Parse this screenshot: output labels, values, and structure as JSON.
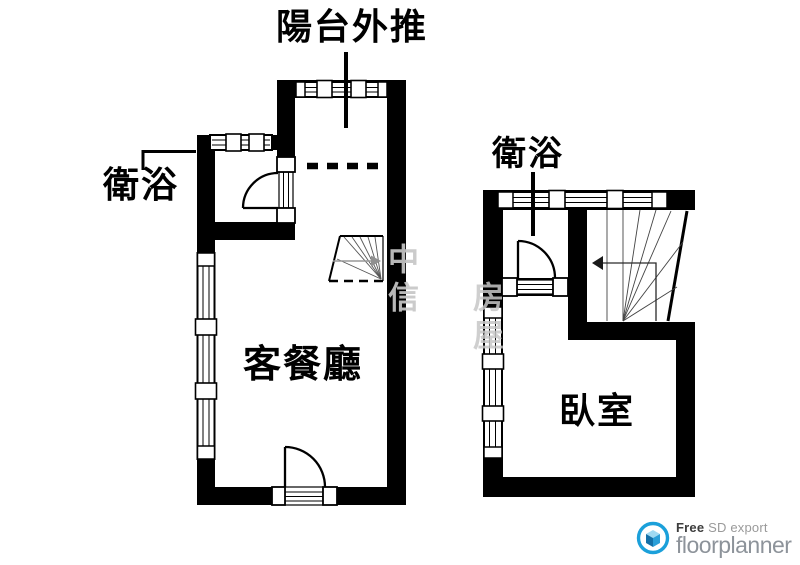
{
  "floorplan": {
    "annotations": {
      "balcony": "陽台外推",
      "bathroom_left": "衛浴",
      "bathroom_right": "衛浴"
    },
    "rooms": {
      "living_dining": "客餐廳",
      "bedroom": "臥室"
    },
    "watermark": {
      "col1": "中信",
      "col2": "房屋"
    },
    "colors": {
      "wall": "#000000",
      "background": "#ffffff",
      "watermark": "#c7c7c7",
      "stair_line": "#555555",
      "walk_arrow_left": "#909090",
      "walk_arrow_right": "#1a1a1a"
    }
  },
  "footer_logo": {
    "free_label": "Free",
    "export_label": " SD export",
    "brand": "floorplanner",
    "ring_color": "#1ba0da",
    "brand_color": "#8d939a"
  }
}
